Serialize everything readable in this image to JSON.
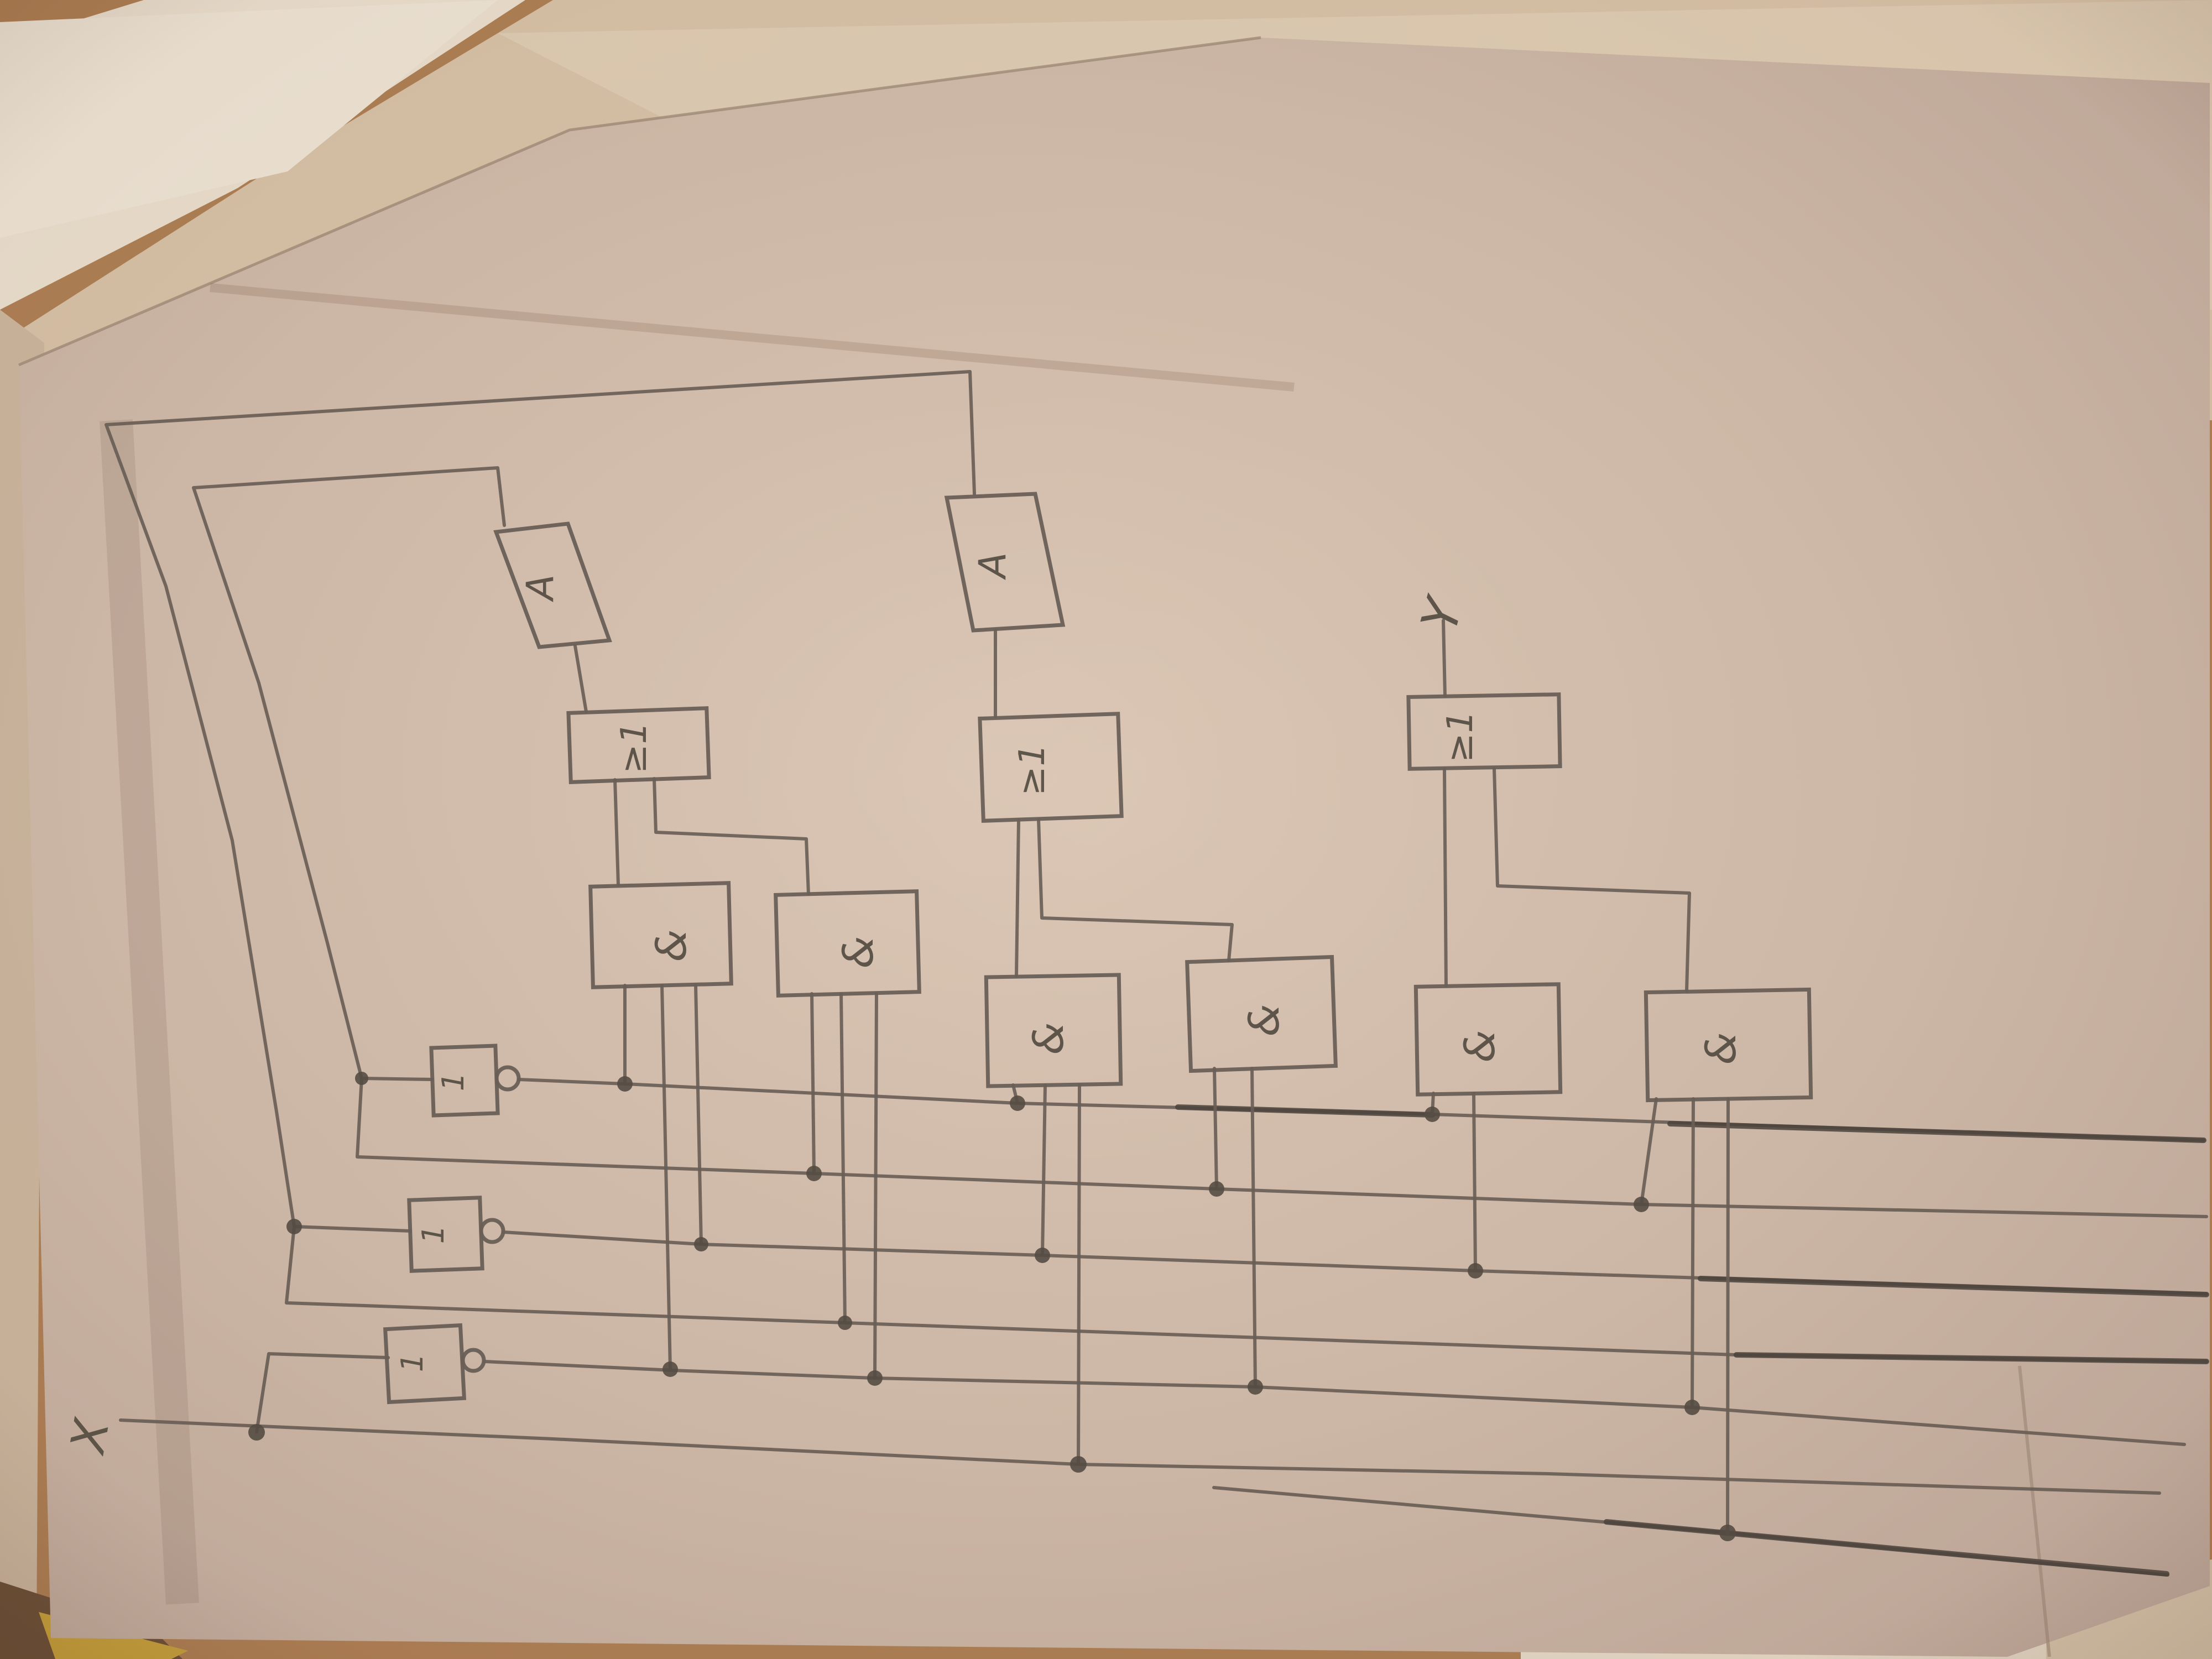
{
  "signals": {
    "input_label": "X",
    "output_label": "Y"
  },
  "gates": {
    "not1": {
      "type": "not",
      "label": "1"
    },
    "not2": {
      "type": "not",
      "label": "1"
    },
    "not3": {
      "type": "not",
      "label": "1"
    },
    "and1": {
      "type": "and",
      "label": "&"
    },
    "and2": {
      "type": "and",
      "label": "&"
    },
    "and3": {
      "type": "and",
      "label": "&"
    },
    "and4": {
      "type": "and",
      "label": "&"
    },
    "and5": {
      "type": "and",
      "label": "&"
    },
    "and6": {
      "type": "and",
      "label": "&"
    },
    "or1": {
      "type": "or",
      "label": "≥1"
    },
    "or2": {
      "type": "or",
      "label": "≥1"
    },
    "or3": {
      "type": "or",
      "label": "≥1"
    },
    "delay1": {
      "type": "delay",
      "label": "A"
    },
    "delay2": {
      "type": "delay",
      "label": "A"
    }
  },
  "colors": {
    "pencil": "#6b6158",
    "pencil_dark": "#4b443d",
    "paper": "#d5bfae",
    "table": "#a87c52"
  }
}
